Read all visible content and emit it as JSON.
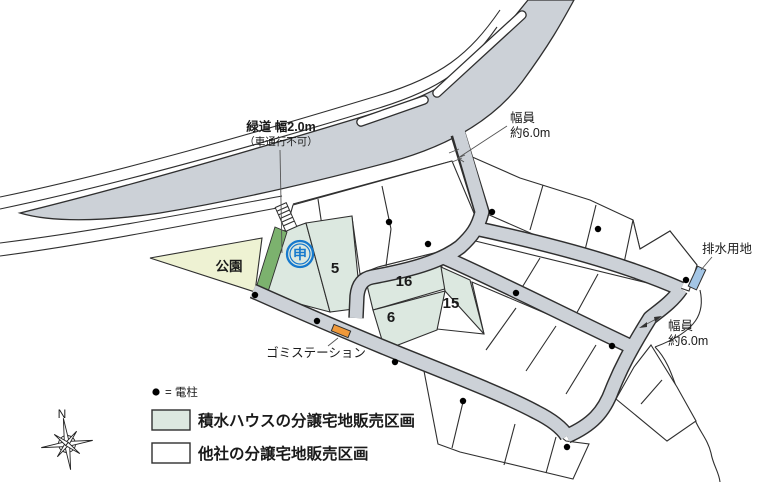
{
  "map": {
    "green_path_label": {
      "line1": "緑道 幅2.0m",
      "line2": "（車通行不可）"
    },
    "road_width_top": {
      "line1": "幅員",
      "line2": "約6.0m"
    },
    "road_width_bottom": {
      "line1": "幅員",
      "line2": "約6.0m"
    },
    "drainage_label": "排水用地",
    "park_label": "公園",
    "garbage_label": "ゴミステーション",
    "application_mark": "申",
    "lots": {
      "lot5": "5",
      "lot16": "16",
      "lot15": "15",
      "lot6": "6"
    },
    "compass_north": "N"
  },
  "legend": {
    "pole": {
      "symbol": "●",
      "text": "= 電柱"
    },
    "items": [
      {
        "label": "積水ハウスの分譲宅地販売区画",
        "swatch": "#dce8e0"
      },
      {
        "label": "他社の分譲宅地販売区画",
        "swatch": "#ffffff"
      }
    ]
  },
  "colors": {
    "road": "#ccd1d7",
    "lot_green": "#dce8e0",
    "park": "#eef2d3",
    "greenway": "#7cb26e",
    "mark_blue": "#1679cd",
    "drainage": "#a4c6e6",
    "garbage": "#f0993a",
    "line": "#2f2f2f",
    "text": "#1a1a1a"
  }
}
